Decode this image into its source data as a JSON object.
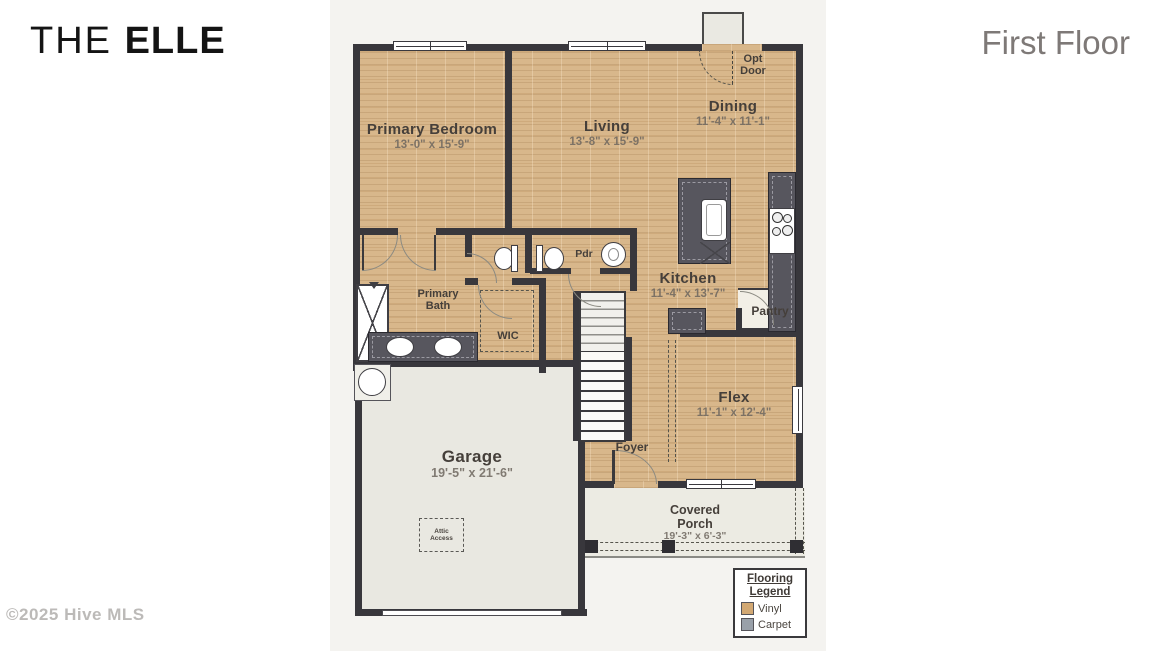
{
  "header": {
    "title_prefix": "THE ",
    "title_main": "ELLE",
    "floor": "First Floor"
  },
  "footer": {
    "copyright": "©2025 Hive MLS"
  },
  "rooms": {
    "primary_bedroom": {
      "name": "Primary Bedroom",
      "dims": "13'-0\" x 15'-9\""
    },
    "living": {
      "name": "Living",
      "dims": "13'-8\" x 15'-9\""
    },
    "dining": {
      "name": "Dining",
      "dims": "11'-4\" x 11'-1\""
    },
    "kitchen": {
      "name": "Kitchen",
      "dims": "11'-4\" x 13'-7\""
    },
    "flex": {
      "name": "Flex",
      "dims": "11'-1\" x 12'-4\""
    },
    "garage": {
      "name": "Garage",
      "dims": "19'-5\" x 21'-6\""
    },
    "covered_porch": {
      "line1": "Covered",
      "line2": "Porch",
      "dims": "19'-3\" x 6'-3\""
    },
    "primary_bath": {
      "line1": "Primary",
      "line2": "Bath"
    },
    "wic": {
      "name": "WIC"
    },
    "pdr": {
      "name": "Pdr"
    },
    "pantry": {
      "name": "Pantry"
    },
    "foyer": {
      "name": "Foyer"
    },
    "opt_door": {
      "line1": "Opt",
      "line2": "Door"
    },
    "attic": {
      "line1": "Attic",
      "line2": "Access"
    }
  },
  "legend": {
    "title_line1": "Flooring",
    "title_line2": "Legend",
    "items": [
      {
        "label": "Vinyl",
        "color": "#d2a873"
      },
      {
        "label": "Carpet",
        "color": "#99a0a9"
      }
    ]
  }
}
